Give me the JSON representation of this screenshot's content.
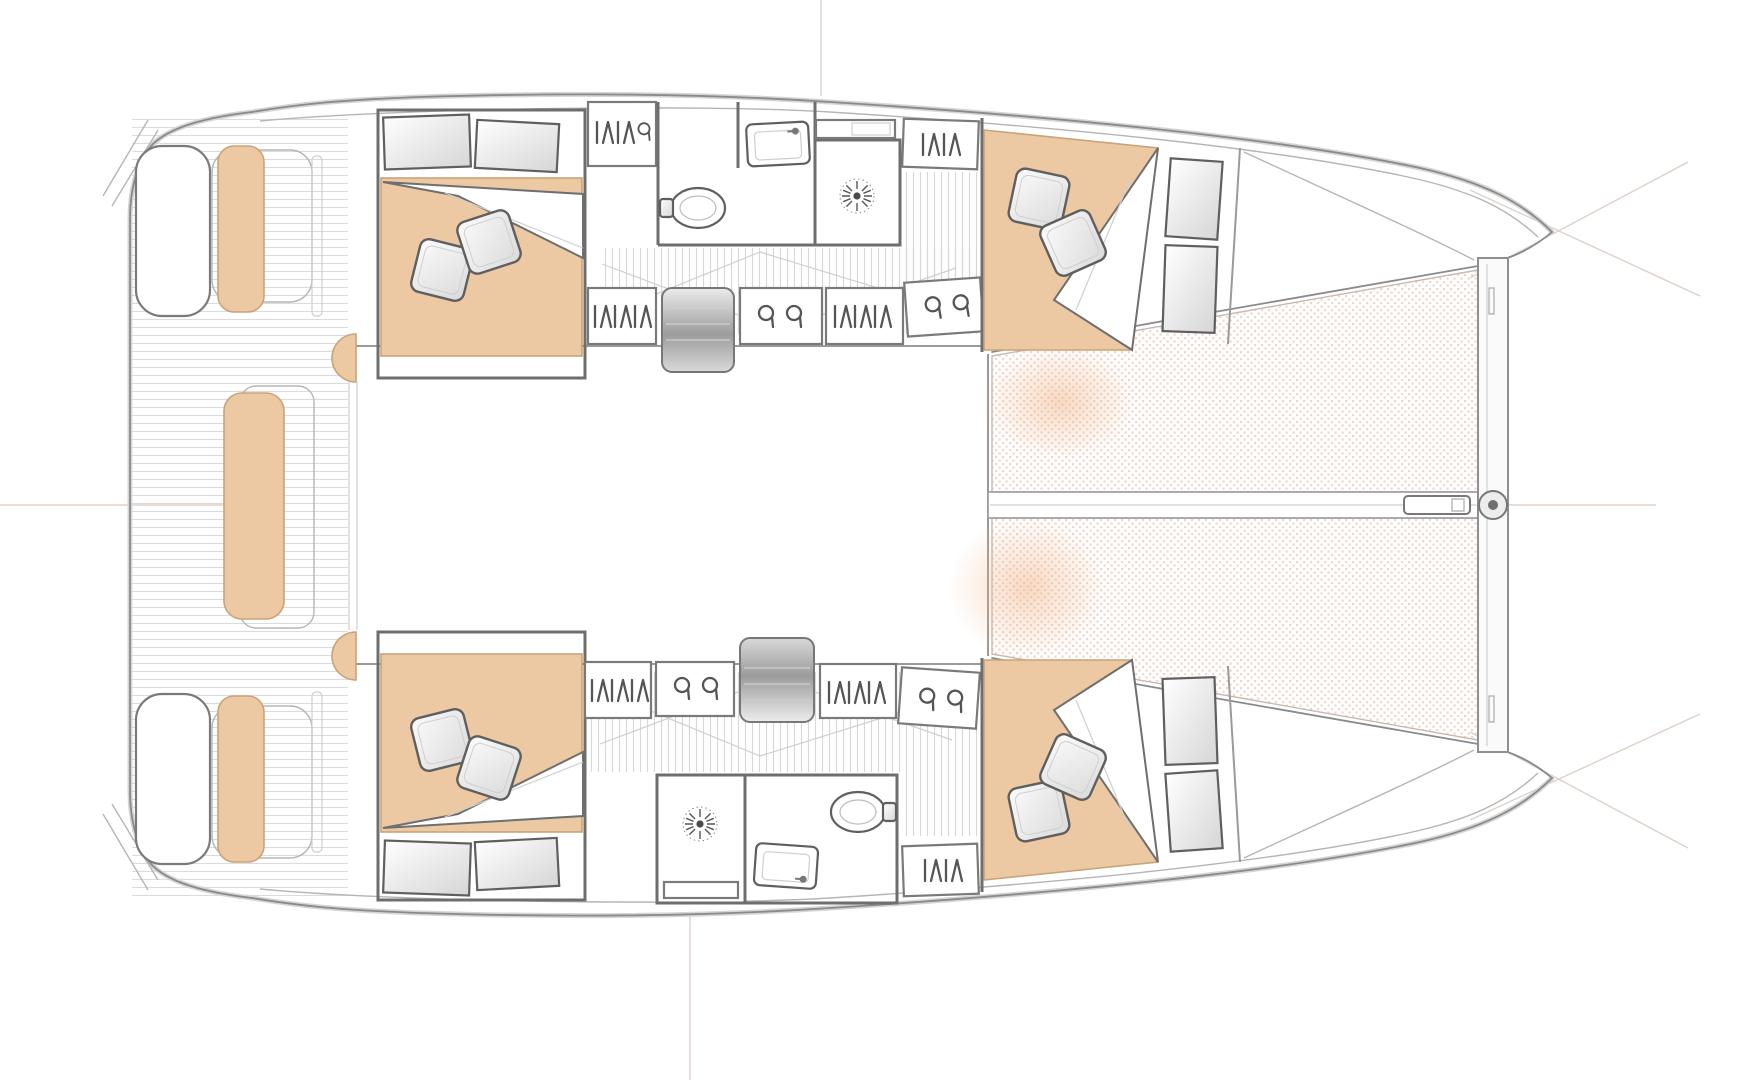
{
  "diagram": {
    "type": "floorplan",
    "subject": "sailing catamaran overhead accommodation and deck plan",
    "orientation": {
      "bow": "right",
      "stern": "left",
      "symmetry": "mirrored about horizontal centerline"
    },
    "cockpit": {
      "floor": "teak planking (horizontal strips)",
      "items": [
        {
          "name": "swim-platform",
          "side": "port"
        },
        {
          "name": "swim-platform",
          "side": "starboard"
        },
        {
          "name": "transom-bench-cushion",
          "side": "port"
        },
        {
          "name": "transom-bench-cushion",
          "side": "starboard"
        },
        {
          "name": "aft-center-bench-cushion",
          "side": "centerline"
        },
        {
          "name": "helm-seat",
          "side": "port"
        },
        {
          "name": "helm-seat",
          "side": "starboard"
        },
        {
          "name": "saloon-door",
          "side": "centerline"
        }
      ]
    },
    "hulls": {
      "port": {
        "aft_cabin": {
          "furniture": [
            "double-berth-cushion",
            "pillow",
            "pillow",
            "duvet-fold",
            "storage-shelf",
            "storage-shelf"
          ]
        },
        "bathroom": {
          "order_fore_to_aft": "locker, vanity, sink, shower",
          "fixtures": [
            "louver-locker",
            "vent-locker",
            "toilet",
            "sink-vanity",
            "shower-stall",
            "shower-drain",
            "louver-locker"
          ]
        },
        "passageway": {
          "floor": "planked (vertical strips)",
          "features": [
            "companionway-steps",
            "louver-locker",
            "vent-locker",
            "louver-locker",
            "vent-locker",
            "convertible-berth-outline"
          ]
        },
        "forward_cabin": {
          "furniture": [
            "double-berth-cushion",
            "pillow",
            "pillow",
            "duvet-fold",
            "storage-shelf",
            "storage-shelf"
          ]
        }
      },
      "starboard": {
        "aft_cabin": {
          "furniture": [
            "double-berth-cushion",
            "pillow",
            "pillow",
            "duvet-fold",
            "storage-shelf",
            "storage-shelf"
          ]
        },
        "bathroom": {
          "order_fore_to_aft": "shower, toilet+sink, locker",
          "fixtures": [
            "shower-stall",
            "shower-drain",
            "toilet",
            "sink-vanity",
            "louver-locker"
          ]
        },
        "passageway": {
          "floor": "planked (vertical strips)",
          "features": [
            "louver-locker",
            "vent-locker",
            "companionway-steps",
            "louver-locker",
            "vent-locker",
            "convertible-berth-outline"
          ]
        },
        "forward_cabin": {
          "furniture": [
            "double-berth-cushion",
            "pillow",
            "pillow",
            "duvet-fold",
            "storage-shelf",
            "storage-shelf"
          ]
        }
      }
    },
    "foredeck": {
      "items": [
        "trampoline-net-port",
        "trampoline-net-starboard",
        "longitudinal-beam",
        "forward-crossbeam",
        "bowsprit",
        "anchor-roller-fitting"
      ]
    },
    "reference_marks": [
      "centerline-left",
      "centerline-right",
      "station-line-top",
      "station-line-bottom",
      "bow-crosshair-port",
      "bow-crosshair-starboard"
    ],
    "symbols": [
      {
        "name": "pillow-icon",
        "shape": "rotated rounded square with inner border"
      },
      {
        "name": "louver-hatch-icon",
        "shape": "vertical and zigzag strokes"
      },
      {
        "name": "vent-hook-icon",
        "shape": "open ring with tail, drawn in pairs"
      },
      {
        "name": "shower-drain-icon",
        "shape": "starburst with dotted ring"
      },
      {
        "name": "anchor-roller-icon",
        "shape": "concentric circles on crossbeam"
      }
    ],
    "counts": {
      "cabins": 4,
      "bathrooms": 2,
      "pillows": 8,
      "trampoline_panels": 2
    }
  },
  "colors": {
    "background": "#ffffff",
    "hull-line": "#8a8a8a",
    "hull-shadow": "#d5d5d5",
    "wall": "#6e6e6e",
    "furniture-stroke": "#5f5f5f",
    "cushion": "#ecc9a2",
    "cushion-edge": "#c9a379",
    "net-dot": "#e2b4a2",
    "plank-stripe": "#dcdcdc",
    "corridor-stripe": "#d8d8d8",
    "steps-dark": "#9c9c9c",
    "steps-light": "#ececec",
    "glow": "#f0b488",
    "construction": "#ddd2ca",
    "thin-line": "#b5b5b5"
  }
}
